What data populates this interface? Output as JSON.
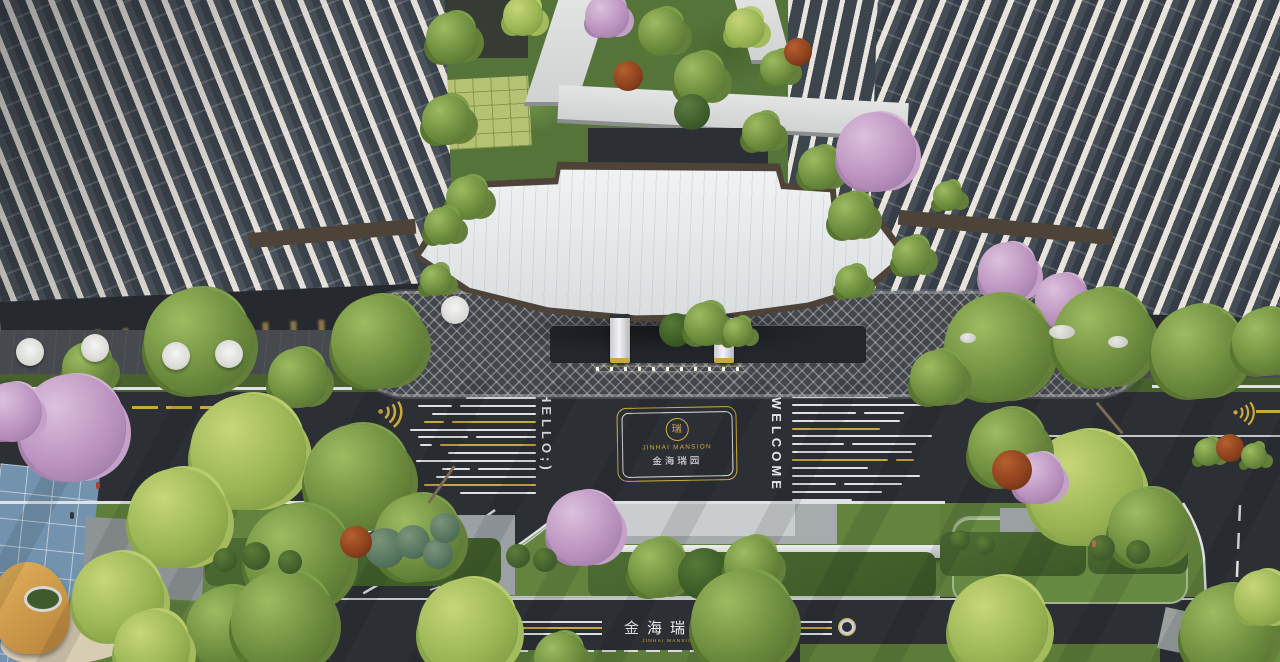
{
  "title": "Jinhai Mansion residential entrance — aerial render",
  "emblem": {
    "seal_char": "瑞",
    "name_en": "JINHAI MANSION",
    "name_cn": "金海瑞园"
  },
  "road_text": {
    "left": "HELLO;)",
    "right": "WELCOME"
  },
  "gate_label": {
    "name_cn": "金海瑞园",
    "name_en": "JINHAI MANSION"
  },
  "colors": {
    "asphalt": "#2c2f34",
    "road_line_white": "#dfe2e5",
    "road_line_yellow": "#c9a83c",
    "grass": "#64833e",
    "canopy_roof": "#e9ebec",
    "canopy_trim": "#4e4339",
    "plaza": "#43464b",
    "gold": "#cfae3e",
    "blue_playground": "#7292ad",
    "dome_gold": "#d8a455"
  },
  "stripes": {
    "left": [
      {
        "segs": [
          [
            70,
            "w"
          ]
        ]
      },
      {
        "segs": [
          [
            34,
            "w"
          ],
          [
            76,
            "w"
          ]
        ]
      },
      {
        "segs": [
          [
            104,
            "w"
          ]
        ]
      },
      {
        "segs": [
          [
            20,
            "y"
          ],
          [
            84,
            "y"
          ]
        ]
      },
      {
        "segs": [
          [
            126,
            "w"
          ]
        ]
      },
      {
        "segs": [
          [
            50,
            "w"
          ],
          [
            60,
            "w"
          ]
        ]
      },
      {
        "segs": [
          [
            12,
            "w"
          ],
          [
            96,
            "y"
          ]
        ]
      },
      {
        "segs": [
          [
            88,
            "w"
          ]
        ]
      },
      {
        "segs": [
          [
            120,
            "w"
          ]
        ]
      },
      {
        "segs": [
          [
            28,
            "w"
          ],
          [
            58,
            "w"
          ]
        ]
      },
      {
        "segs": [
          [
            100,
            "w"
          ]
        ]
      },
      {
        "segs": [
          [
            112,
            "y"
          ]
        ]
      },
      {
        "segs": [
          [
            76,
            "w"
          ]
        ]
      }
    ],
    "right": [
      {
        "segs": [
          [
            96,
            "w"
          ]
        ]
      },
      {
        "segs": [
          [
            130,
            "w"
          ]
        ]
      },
      {
        "segs": [
          [
            64,
            "w"
          ],
          [
            40,
            "w"
          ]
        ]
      },
      {
        "segs": [
          [
            108,
            "w"
          ]
        ]
      },
      {
        "segs": [
          [
            88,
            "y"
          ]
        ]
      },
      {
        "segs": [
          [
            140,
            "w"
          ]
        ]
      },
      {
        "segs": [
          [
            52,
            "w"
          ],
          [
            64,
            "w"
          ]
        ]
      },
      {
        "segs": [
          [
            120,
            "w"
          ]
        ]
      },
      {
        "segs": [
          [
            96,
            "y"
          ],
          [
            18,
            "y"
          ]
        ]
      },
      {
        "segs": [
          [
            76,
            "w"
          ]
        ]
      },
      {
        "segs": [
          [
            128,
            "w"
          ]
        ]
      },
      {
        "segs": [
          [
            44,
            "w"
          ],
          [
            58,
            "w"
          ]
        ]
      },
      {
        "segs": [
          [
            90,
            "w"
          ]
        ]
      },
      {
        "segs": [
          [
            60,
            "w"
          ]
        ]
      }
    ]
  }
}
